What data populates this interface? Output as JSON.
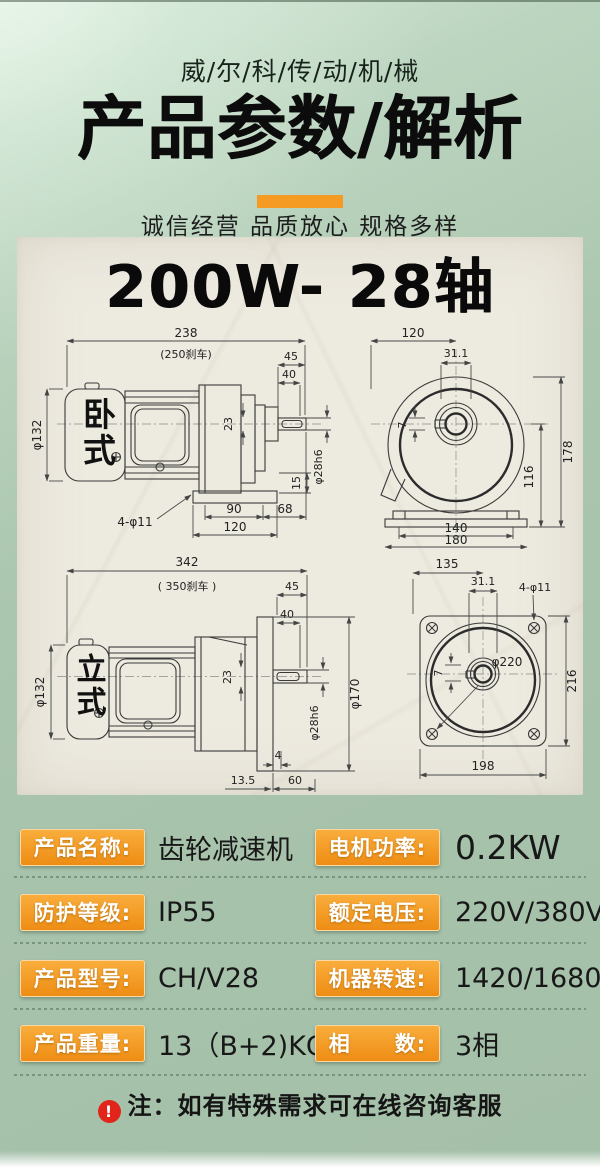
{
  "header": {
    "brand": "威/尔/科/传/动/机/械",
    "title": "产品参数/解析",
    "subtitle": "诚信经营 品质放心 规格多样"
  },
  "drawing": {
    "panel_title": "200W- 28轴",
    "h_side": {
      "label": "卧式",
      "total": "238",
      "brake": "(250刹车)",
      "a": "45",
      "b": "40",
      "dia": "φ132",
      "mid": "23",
      "shaft": "φ28h6",
      "foot": "15",
      "l1": "90",
      "l2": "68",
      "l3": "120",
      "holes": "4-φ11"
    },
    "h_front": {
      "w": "120",
      "hub": "31.1",
      "h": "178",
      "h2": "116",
      "key": "7",
      "base1": "140",
      "base2": "180"
    },
    "v_side": {
      "label": "立式",
      "total": "342",
      "brake": "( 350刹车 )",
      "a": "45",
      "b": "40",
      "dia": "φ132",
      "mid": "23",
      "flange": "φ170",
      "shaft": "φ28h6",
      "gap": "4",
      "l1": "13.5",
      "l2": "60"
    },
    "v_front": {
      "w": "135",
      "hub": "31.1",
      "holes": "4-φ11",
      "dia": "φ220",
      "h": "216",
      "key": "7",
      "base": "198"
    }
  },
  "specs": {
    "rows": [
      {
        "label1": "产品名称:",
        "value1": "齿轮减速机",
        "label2": "电机功率:",
        "value2": "0.2KW"
      },
      {
        "label1": "防护等级:",
        "value1": "IP55",
        "label2": "额定电压:",
        "value2": "220V/380V"
      },
      {
        "label1": "产品型号:",
        "value1": "CH/V28",
        "label2": "机器转速:",
        "value2": "1420/1680r"
      },
      {
        "label1": "产品重量:",
        "value1": "13（B+2)KG",
        "label2": "相　　数:",
        "value2": "3相"
      }
    ]
  },
  "note": {
    "icon": "!",
    "text": "注：如有特殊需求可在线咨询客服"
  },
  "colors": {
    "accent_orange": "#f59a23",
    "chip_gradient_top": "#f9ad3c",
    "chip_gradient_bottom": "#ee8d14",
    "background_green": "#a7c2ab",
    "panel_cream": "#edeae0",
    "alert_red": "#e1251b",
    "text_dark": "#151515"
  }
}
